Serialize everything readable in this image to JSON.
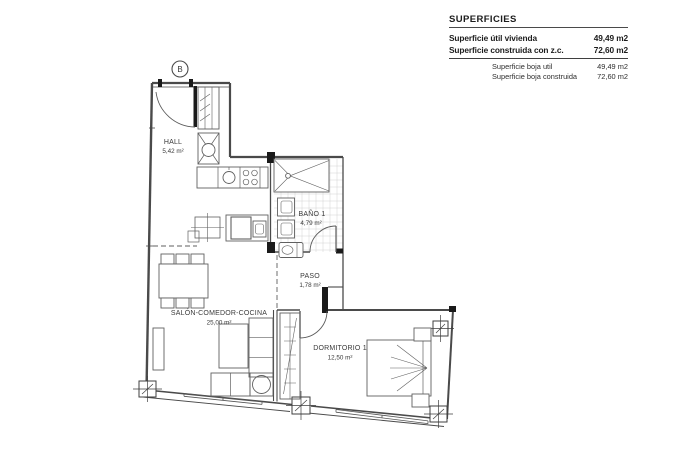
{
  "title_block": {
    "title": "SUPERFICIES",
    "main_rows": [
      {
        "label": "Superficie útil vivienda",
        "value": "49,49 m2"
      },
      {
        "label": "Superficie construida con z.c.",
        "value": "72,60 m2"
      }
    ],
    "secondary_rows": [
      {
        "label": "Superficie boja util",
        "value": "49,49 m2"
      },
      {
        "label": "Superficie boja construida",
        "value": "72,60 m2"
      }
    ]
  },
  "plan": {
    "marker": "B",
    "rooms": {
      "hall": {
        "name": "HALL",
        "area": "5,42 m²"
      },
      "bano": {
        "name": "BAÑO 1",
        "area": "4,79 m²"
      },
      "paso": {
        "name": "PASO",
        "area": "1,78 m²"
      },
      "salon": {
        "name": "SALÓN-COMEDOR-COCINA",
        "area": "25,00 m²"
      },
      "dormitorio": {
        "name": "DORMITORIO 1",
        "area": "12,50 m²"
      }
    }
  },
  "colors": {
    "wall_line": "#4a4a4a",
    "furniture_line": "#606060",
    "jamb_black": "#1a1a1a",
    "tile_line": "#d2d2d2",
    "background": "#ffffff"
  }
}
